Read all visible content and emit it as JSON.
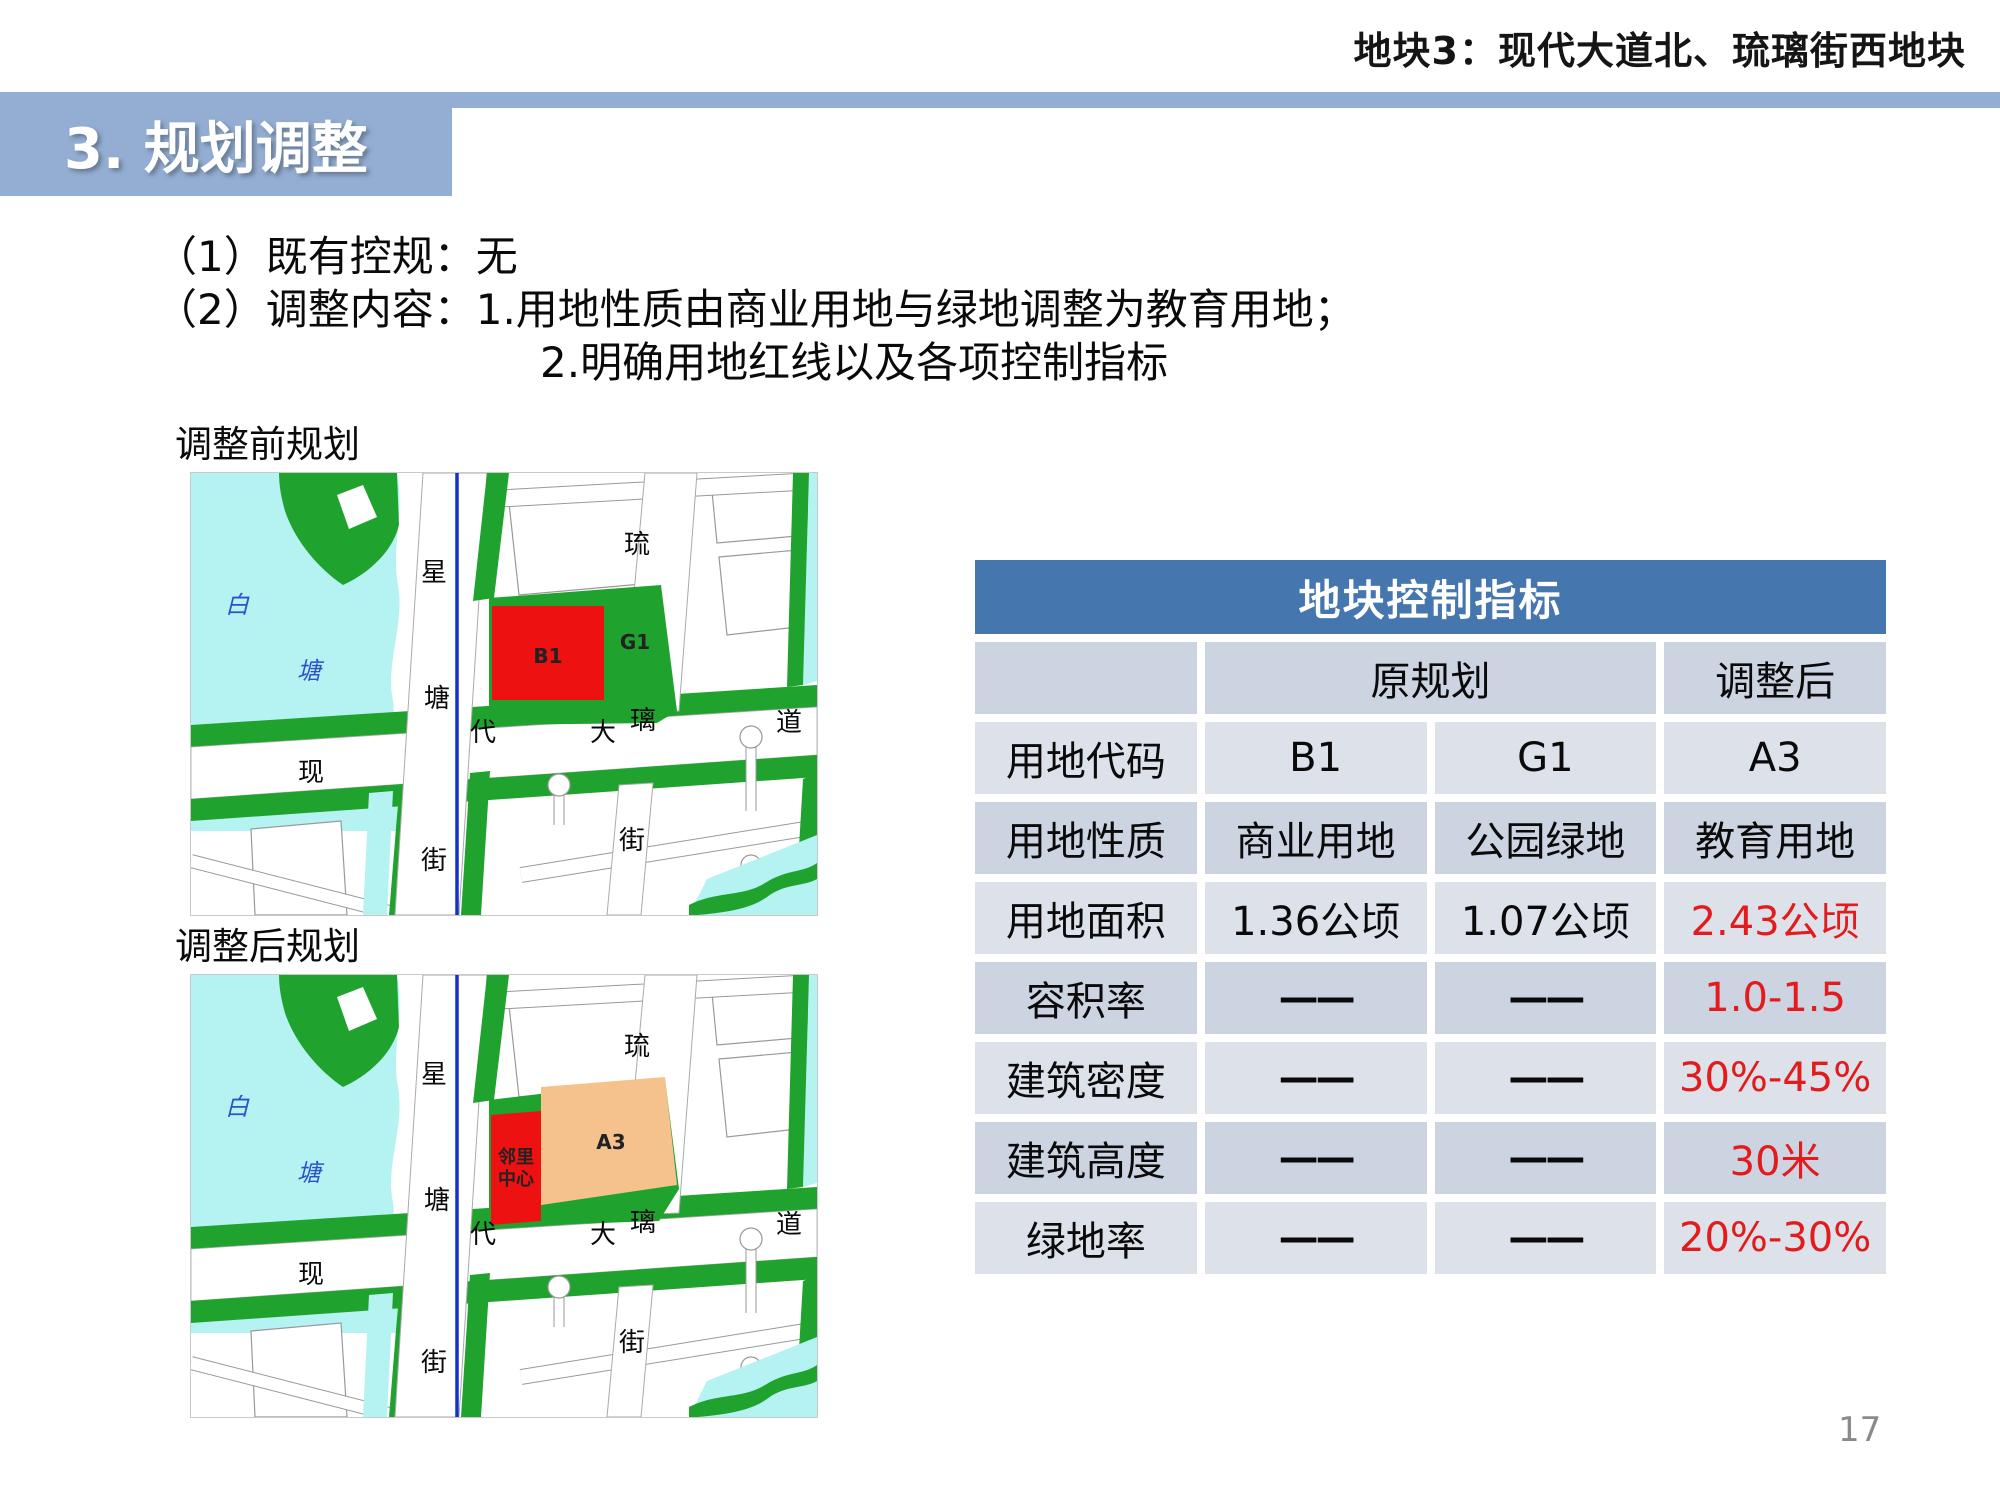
{
  "header": {
    "plot_title": "地块3：现代大道北、琉璃街西地块"
  },
  "section": {
    "title": "3. 规划调整"
  },
  "body": {
    "line1": "（1）既有控规：无",
    "line2_prefix": "（2）调整内容：",
    "line2_item": "1.用地性质由商业用地与绿地调整为教育用地；",
    "line3_item": "2.明确用地红线以及各项控制指标"
  },
  "maps": {
    "before_title": "调整前规划",
    "after_title": "调整后规划",
    "labels": {
      "water1": "白",
      "water2": "塘",
      "v1a": "星",
      "v1b": "塘",
      "v1c": "街",
      "v2a": "琉",
      "v2b": "璃",
      "v2c": "街",
      "h1": "现",
      "h2": "代",
      "h3": "大",
      "h4": "道"
    },
    "before": {
      "block1": "B1",
      "block2": "G1"
    },
    "after": {
      "block1_line1": "邻里",
      "block1_line2": "中心",
      "block2": "A3"
    }
  },
  "table": {
    "title": "地块控制指标",
    "col_header": {
      "original": "原规划",
      "adjusted": "调整后"
    },
    "rows": [
      {
        "label": "用地代码",
        "v1": "B1",
        "v2": "G1",
        "v3": "A3"
      },
      {
        "label": "用地性质",
        "v1": "商业用地",
        "v2": "公园绿地",
        "v3": "教育用地"
      },
      {
        "label": "用地面积",
        "v1": "1.36公顷",
        "v2": "1.07公顷",
        "v3": "2.43公顷"
      },
      {
        "label": "容积率",
        "v1": "——",
        "v2": "——",
        "v3": "1.0-1.5"
      },
      {
        "label": "建筑密度",
        "v1": "——",
        "v2": "——",
        "v3": "30%-45%"
      },
      {
        "label": "建筑高度",
        "v1": "——",
        "v2": "——",
        "v3": "30米"
      },
      {
        "label": "绿地率",
        "v1": "——",
        "v2": "——",
        "v3": "20%-30%"
      }
    ]
  },
  "page_number": "17",
  "colors": {
    "accent_band": "#93aed2",
    "table_header": "#4576ad",
    "row_dark": "#ccd3e1",
    "row_light": "#dde1ea",
    "red_text": "#e31b1c",
    "map_green": "#20a32e",
    "map_water": "#b5f2f2",
    "map_red": "#ee1111",
    "map_orange": "#f5c28e",
    "map_river": "#1430c8",
    "water_label": "#3050c8",
    "page_gray": "#8a8a8a"
  }
}
